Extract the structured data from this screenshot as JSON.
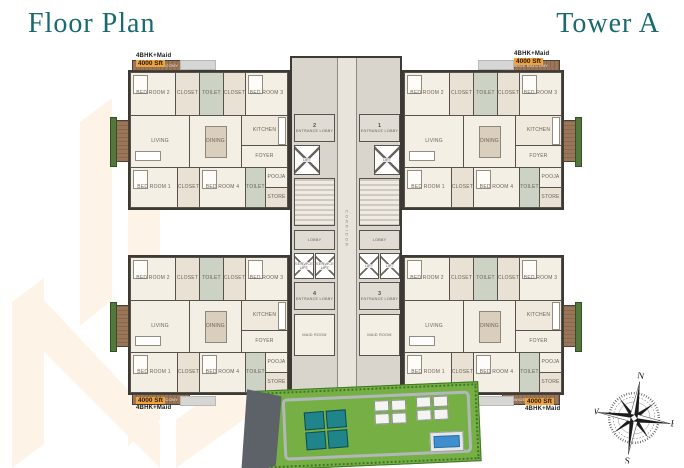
{
  "header": {
    "title_left": "Floor Plan",
    "title_right": "Tower A"
  },
  "units": [
    {
      "position": "top-left",
      "type": "4BHK+Maid",
      "area": "4000 Sft"
    },
    {
      "position": "top-right",
      "type": "4BHK+Maid",
      "area": "4000 Sft"
    },
    {
      "position": "bottom-left",
      "type": "4BHK+Maid",
      "area": "4000 Sft"
    },
    {
      "position": "bottom-right",
      "type": "4BHK+Maid",
      "area": "4000 Sft"
    }
  ],
  "unit_rooms": [
    {
      "label": "BED ROOM 2"
    },
    {
      "label": "CLOSET"
    },
    {
      "label": "TOILET"
    },
    {
      "label": "CLOSET"
    },
    {
      "label": "BED ROOM 3"
    },
    {
      "label": "LIVING"
    },
    {
      "label": "DINING"
    },
    {
      "label": "KITCHEN"
    },
    {
      "label": "FOYER"
    },
    {
      "label": "BED ROOM 1"
    },
    {
      "label": "CLOSET"
    },
    {
      "label": "BED ROOM 4"
    },
    {
      "label": "TOILET"
    },
    {
      "label": "POOJA"
    },
    {
      "label": "STORE"
    }
  ],
  "labels": {
    "balcony": "WIDE BALCONY"
  },
  "core": {
    "corridor": "CORRIDOR",
    "entrance_lobby": "ENTRANCE LOBBY",
    "lobbies": [
      {
        "num": "2"
      },
      {
        "num": "1"
      },
      {
        "num": "4"
      },
      {
        "num": "3"
      }
    ],
    "lift": "LIFT",
    "service_lift": "SERVICE LIFT",
    "lobby": "LOBBY",
    "maid_room": "MAID ROOM"
  },
  "compass": {
    "north": "N",
    "east": "E",
    "south": "S",
    "west": "W"
  },
  "colors": {
    "accent_teal": "#186a6f",
    "area_highlight": "#f1a33e",
    "wall": "#3d3a36",
    "unit_floor": "#f3eee4",
    "core_floor": "#d9d4cc",
    "balcony_wood": "#96745a",
    "planter_green": "#53783e",
    "site_green": "#76b044",
    "tower_teal": "#20858a",
    "pool_blue": "#3f8fd0",
    "watermark_cream": "#fdf4e7"
  }
}
